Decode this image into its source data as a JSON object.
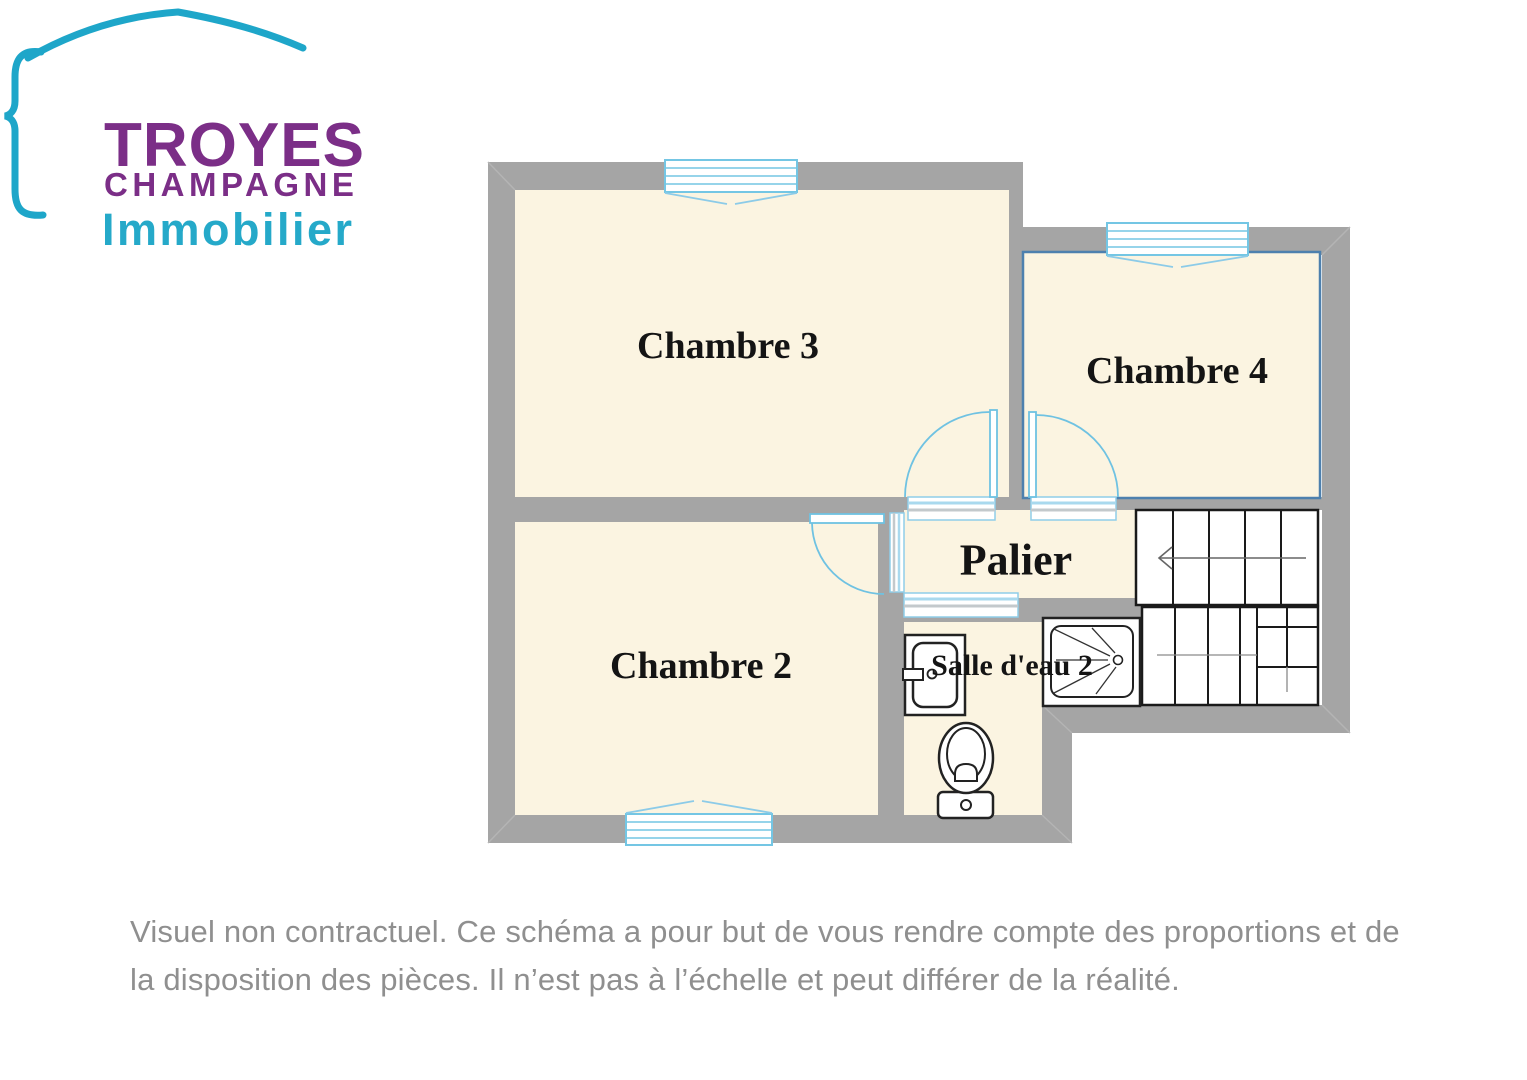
{
  "logo": {
    "line1": "TROYES",
    "line2": "CHAMPAGNE",
    "line3": "Immobilier",
    "brand_purple": "#7b2e87",
    "brand_teal": "#25a9c9"
  },
  "plan": {
    "rooms": [
      {
        "id": "chambre-3",
        "label": "Chambre 3"
      },
      {
        "id": "chambre-4",
        "label": "Chambre 4"
      },
      {
        "id": "chambre-2",
        "label": "Chambre 2"
      },
      {
        "id": "palier",
        "label": "Palier"
      },
      {
        "id": "salle-deau-2",
        "label": "Salle d'eau 2"
      }
    ],
    "colors": {
      "wall": "#a5a5a5",
      "room_fill": "#fbf4e1",
      "window_blue": "#74c6e4",
      "door_blue": "#6fc2e2",
      "chambre4_outline": "#4d80ae"
    }
  },
  "disclaimer": {
    "line1": "Visuel non contractuel. Ce schéma a pour but de vous rendre compte des proportions et de",
    "line2": "la disposition des pièces. Il n’est pas à l’échelle et peut différer de la réalité."
  }
}
